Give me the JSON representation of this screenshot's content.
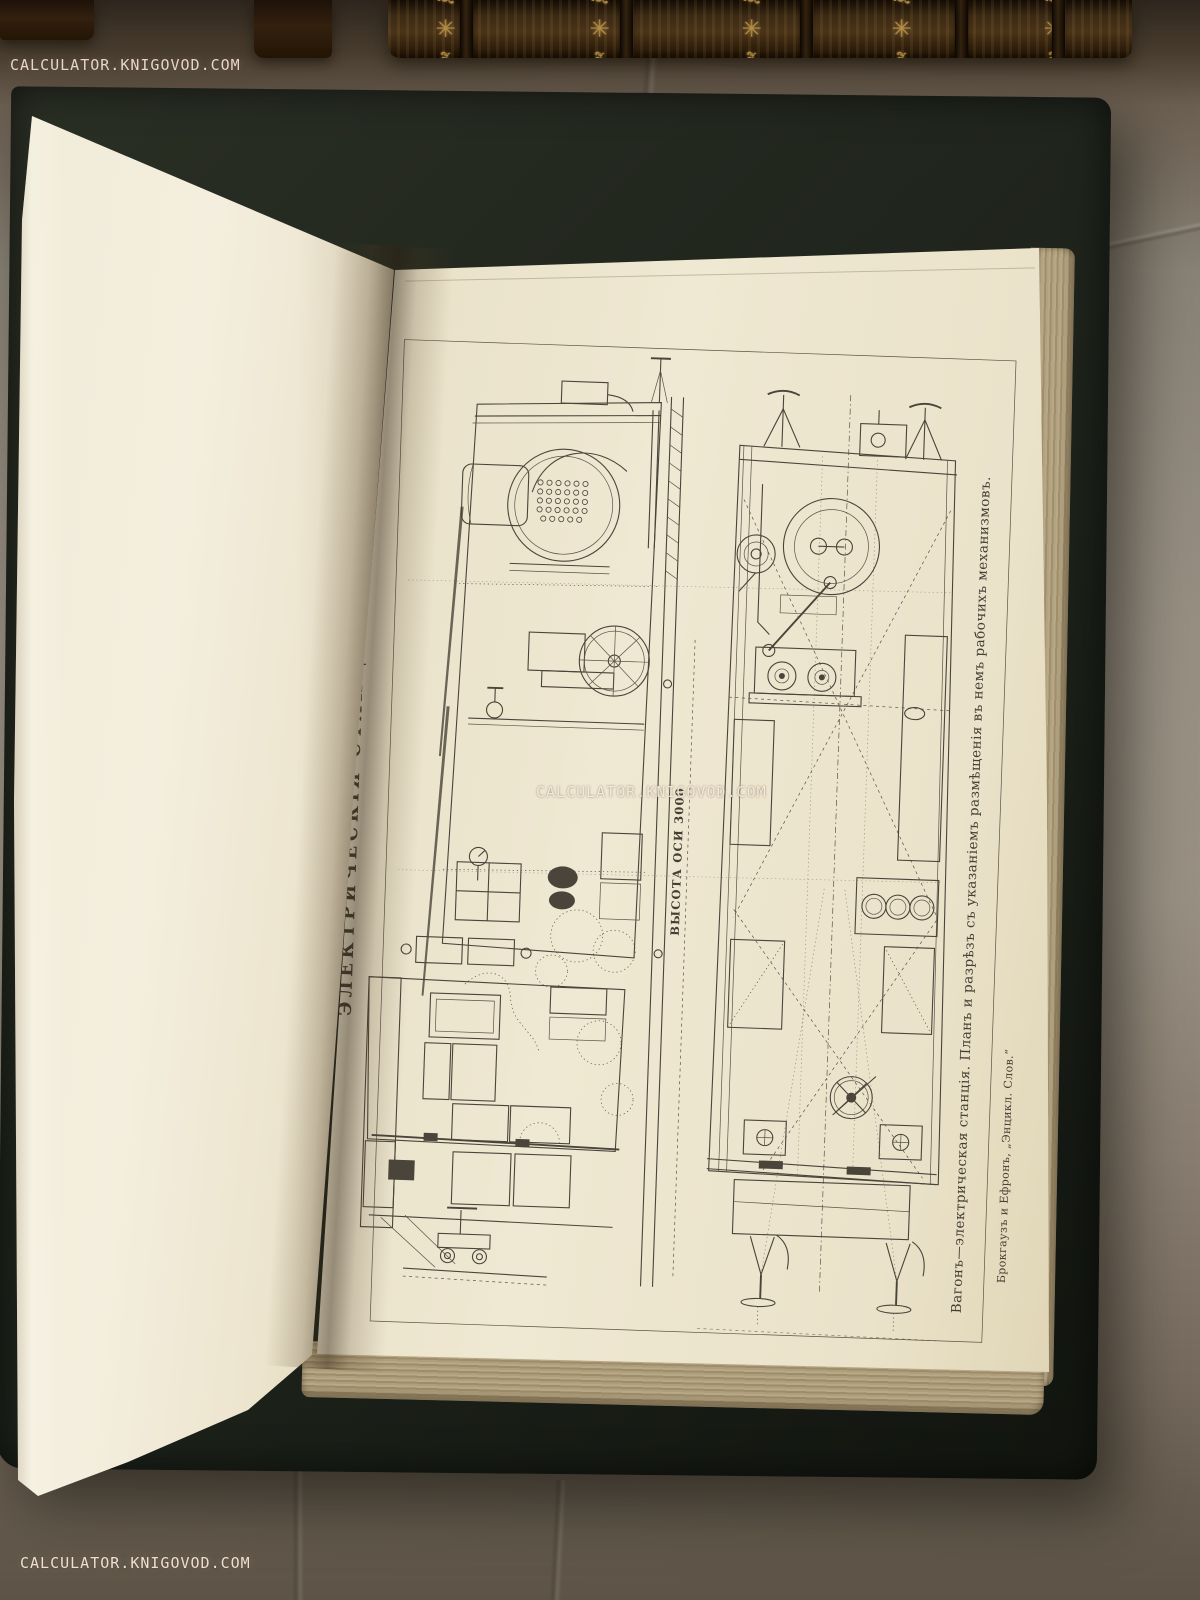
{
  "watermarks": {
    "top_left": "CALCULATOR.KNIGOVOD.COM",
    "center": "CALCULATOR.KNIGOVOD.COM",
    "bottom_left": "CALCULATOR.KNIGOVOD.COM"
  },
  "plate": {
    "title": "ЭЛЕКТРИЧЕСКІЯ СТАНЦІИ. VI.",
    "axis_label": "ВЫСОТА ОСИ 3000",
    "caption": "Вагонъ—электрическая станція. Планъ и разрѣзъ съ указаніемъ размѣщенія въ немъ рабочихъ механизмовъ.",
    "imprint": "Брокгаузъ и Ефронъ, „Энцикл. Слов.“"
  },
  "decor": {
    "spine_ornament": "❦ ✳ ❧"
  },
  "colors": {
    "fabric": "#8d8276",
    "page_cream": "#efe8d2",
    "engraving_ink": "#4a443a",
    "cover_green": "#1c211a",
    "gold_tooling": "#c69c4d",
    "page_edge_tan": "#b7a888",
    "watermark": "#f2e9dc"
  }
}
